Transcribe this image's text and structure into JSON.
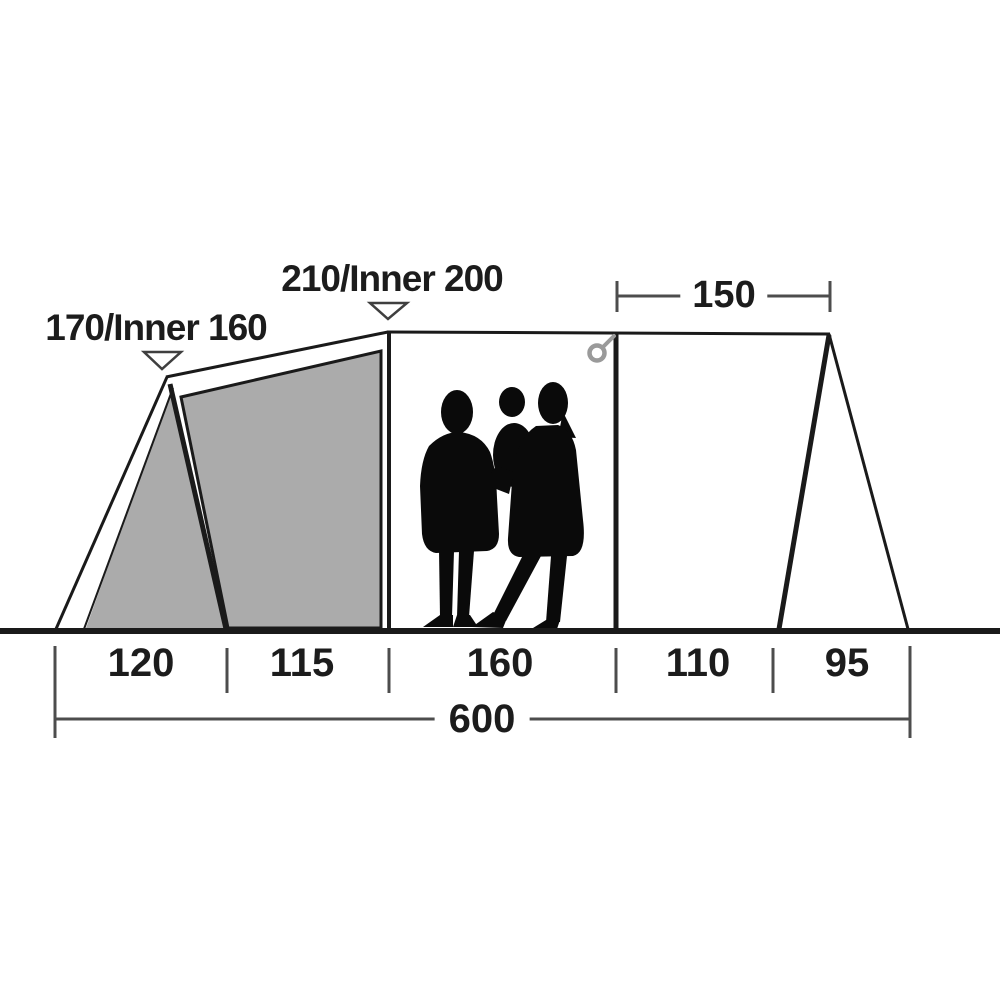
{
  "tent": {
    "peak_labels": [
      {
        "label": "170/Inner 160"
      },
      {
        "label": "210/Inner 200"
      }
    ],
    "top_dimension": {
      "label": "150"
    },
    "bottom_segments": [
      {
        "label": "120"
      },
      {
        "label": "115"
      },
      {
        "label": "160"
      },
      {
        "label": "110"
      },
      {
        "label": "95"
      }
    ],
    "total_dimension": {
      "label": "600"
    },
    "colors": {
      "outline": "#1a1a1a",
      "panel": "#ababab",
      "dimension": "#4d4d4d",
      "ring": "#9a9a9a",
      "silhouette": "#0a0a0a"
    }
  }
}
